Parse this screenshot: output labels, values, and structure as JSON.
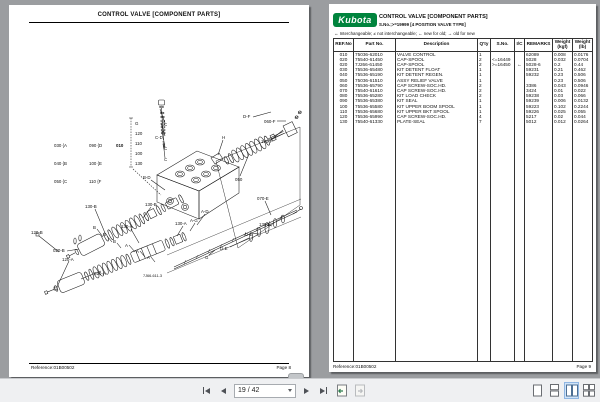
{
  "toolbar": {
    "page_indicator": "19 / 42"
  },
  "left_page": {
    "header": "CONTROL VALVE [COMPONENT PARTS]",
    "figure_code": "7J66-611-3",
    "bracket": {
      "ref": "010",
      "items": [
        "G",
        "120",
        "110",
        "100",
        "130"
      ]
    },
    "legend_items": [
      "030 {A",
      "040 {B",
      "050 {C",
      "090 {D",
      "100 {E",
      "110 {F"
    ],
    "labels": {
      "c1": "C",
      "cd": "C-D",
      "c2": "C",
      "c3": "C",
      "h": "H",
      "df": "D-F",
      "f060": "060-F",
      "f130": "130-F",
      "s050": "050",
      "bd": "B-D",
      "b130_1": "130-B",
      "b130_2": "130-B",
      "ad": "A-D",
      "ag": "A-G",
      "a130_1": "130-A",
      "a130_2": "130-A",
      "e070": "070-E",
      "e130": "130-E",
      "de1": "D-E",
      "de2": "D-E",
      "g": "G",
      "b120": "120-B",
      "b020": "020-B",
      "a120": "120-A",
      "a020": "020-A",
      "lb1": "B",
      "lb2": "B",
      "lb3": "B",
      "la1": "A",
      "la2": "A",
      "la3": "A"
    },
    "footer": {
      "reference": "Reference:01B00502",
      "page": "Page 8"
    }
  },
  "right_page": {
    "logo_text": "Kubota",
    "logo_color": "#00843d",
    "title": "CONTROL VALVE [COMPONENT PARTS]",
    "subtitle": "S.No.;>=19999 [4 POSITION VALVE TYPE]",
    "interchange_legend": "↔ Interchangeable;    ≠ not interchangeable;    ← new for old;    → old for new",
    "table": {
      "headers": [
        "REF.No",
        "Part No.",
        "Description",
        "Q'ty",
        "S.No.",
        "I/C",
        "REMARKS"
      ],
      "weight_kgf": {
        "line1": "Weight",
        "line2": "(kgf)"
      },
      "weight_lb": {
        "line1": "Weight",
        "line2": "(lb)"
      },
      "rows": [
        {
          "ref": "010",
          "part": "75036-62010",
          "desc": "VALVE CONTROL",
          "qty": "1",
          "sno": "",
          "ic": "",
          "remarks": "62089",
          "kgf": "0.008",
          "lb": "0.0176"
        },
        {
          "ref": "020",
          "part": "75540-61450",
          "desc": "CAP-SPOOL",
          "qty": "2",
          "sno": "<=16449",
          "ic": "",
          "remarks": "5028",
          "kgf": "0.032",
          "lb": "0.0704"
        },
        {
          "ref": "020",
          "part": "7J266-61450",
          "desc": "CAP-SPOOL",
          "qty": "2",
          "sno": ">=16450",
          "ic": "←",
          "remarks": "5028-6",
          "kgf": "0.2",
          "lb": "0.44"
        },
        {
          "ref": "030",
          "part": "75536-65480",
          "desc": "KIT DETENT FLOAT",
          "qty": "1",
          "sno": "",
          "ic": "",
          "remarks": "59231",
          "kgf": "0.21",
          "lb": "0.462"
        },
        {
          "ref": "040",
          "part": "75536-65190",
          "desc": "KIT DETENT REGEN.",
          "qty": "1",
          "sno": "",
          "ic": "",
          "remarks": "59232",
          "kgf": "0.23",
          "lb": "0.506"
        },
        {
          "ref": "050",
          "part": "75036-61510",
          "desc": "ASSY RELIEF VALVE",
          "qty": "1",
          "sno": "",
          "ic": "",
          "remarks": "",
          "kgf": "0.23",
          "lb": "0.506"
        },
        {
          "ref": "060",
          "part": "75536-65790",
          "desc": "CAP SCREW-SOC.HD.",
          "qty": "2",
          "sno": "",
          "ic": "",
          "remarks": "3386",
          "kgf": "0.043",
          "lb": "0.0946"
        },
        {
          "ref": "070",
          "part": "75540-61610",
          "desc": "CAP SCREW-SOC.HD.",
          "qty": "2",
          "sno": "",
          "ic": "",
          "remarks": "3424",
          "kgf": "0.01",
          "lb": "0.022"
        },
        {
          "ref": "080",
          "part": "75536-65280",
          "desc": "KIT LOAD CHECK",
          "qty": "2",
          "sno": "",
          "ic": "",
          "remarks": "59238",
          "kgf": "0.03",
          "lb": "0.066"
        },
        {
          "ref": "090",
          "part": "75536-65380",
          "desc": "KIT SEAL",
          "qty": "1",
          "sno": "",
          "ic": "",
          "remarks": "59239",
          "kgf": "0.006",
          "lb": "0.0132"
        },
        {
          "ref": "100",
          "part": "75536-65580",
          "desc": "KIT UPPER BOOM SPOOL",
          "qty": "1",
          "sno": "",
          "ic": "",
          "remarks": "59223",
          "kgf": "0.102",
          "lb": "0.2244"
        },
        {
          "ref": "110",
          "part": "75536-65680",
          "desc": "KIT UPPER BKT SPOOL",
          "qty": "1",
          "sno": "",
          "ic": "",
          "remarks": "59226",
          "kgf": "0.025",
          "lb": "0.055"
        },
        {
          "ref": "120",
          "part": "75536-65990",
          "desc": "CAP SCREW-SOC.HD.",
          "qty": "4",
          "sno": "",
          "ic": "",
          "remarks": "5217",
          "kgf": "0.02",
          "lb": "0.044"
        },
        {
          "ref": "130",
          "part": "75540-61330",
          "desc": "PLATE-SEAL",
          "qty": "7",
          "sno": "",
          "ic": "",
          "remarks": "5012",
          "kgf": "0.012",
          "lb": "0.0264"
        }
      ]
    },
    "footer": {
      "reference": "Reference:01B00502",
      "page": "Page 9"
    }
  }
}
